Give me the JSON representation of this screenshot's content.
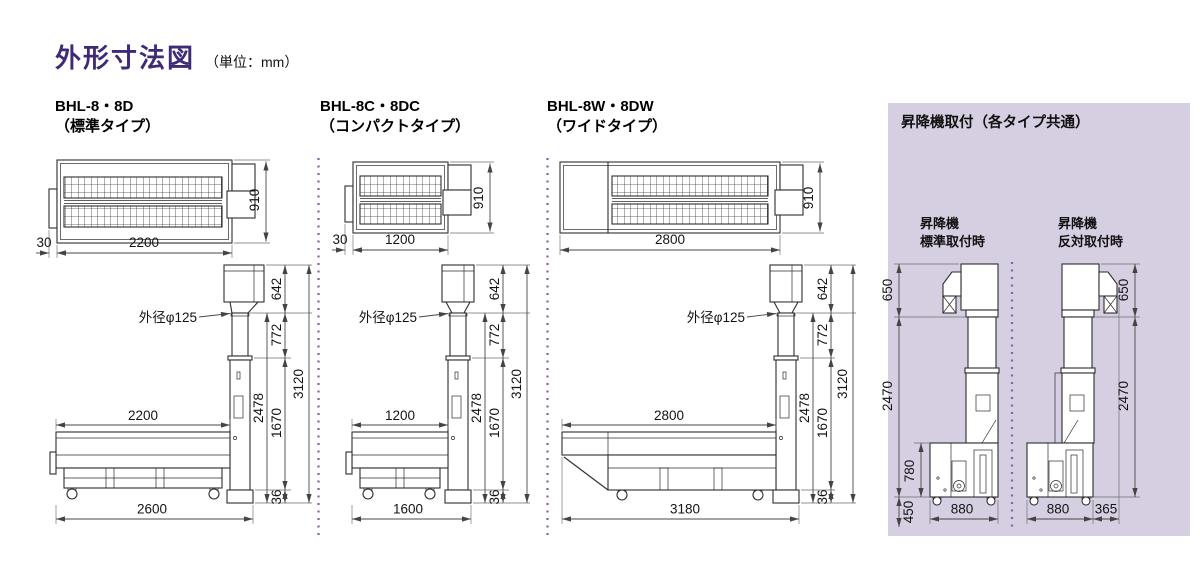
{
  "title": {
    "text": "外形寸法図",
    "unit": "（単位：mm）"
  },
  "colors": {
    "accent": "#3f2a78",
    "panel_bg": "#d6cee1",
    "divider": "#8a63af"
  },
  "variants": [
    {
      "model": "BHL-8・8D",
      "type": "（標準タイプ）",
      "top": {
        "length": "2200",
        "inlet": "30",
        "width": "910"
      },
      "side": {
        "pipe_note": "外径φ125",
        "bed": "2200",
        "overall_w": "2600",
        "hopper_h": "642",
        "pipe_h": "772",
        "elev_h": "2478",
        "bed_h": "1670",
        "base_h": "36",
        "overall_h": "3120"
      }
    },
    {
      "model": "BHL-8C・8DC",
      "type": "（コンパクトタイプ）",
      "top": {
        "length": "1200",
        "inlet": "30",
        "width": "910"
      },
      "side": {
        "pipe_note": "外径φ125",
        "bed": "1200",
        "overall_w": "1600",
        "hopper_h": "642",
        "pipe_h": "772",
        "elev_h": "2478",
        "bed_h": "1670",
        "base_h": "36",
        "overall_h": "3120"
      }
    },
    {
      "model": "BHL-8W・8DW",
      "type": "（ワイドタイプ）",
      "top": {
        "length": "2800",
        "width": "910"
      },
      "side": {
        "pipe_note": "外径φ125",
        "bed": "2800",
        "overall_w": "3180",
        "hopper_h": "642",
        "pipe_h": "772",
        "elev_h": "2478",
        "bed_h": "1670",
        "base_h": "36",
        "overall_h": "3120"
      }
    }
  ],
  "mount_panel": {
    "title": "昇降機取付（各タイプ共通）",
    "standard": {
      "label": [
        "昇降機",
        "標準取付時"
      ],
      "spout_h": "650",
      "elev_h": "2470",
      "base_h": "780",
      "outlet_h": "450",
      "width": "880"
    },
    "reversed": {
      "label": [
        "昇降機",
        "反対取付時"
      ],
      "spout_h": "650",
      "elev_h": "2470",
      "width": "880",
      "offset": "365"
    }
  }
}
